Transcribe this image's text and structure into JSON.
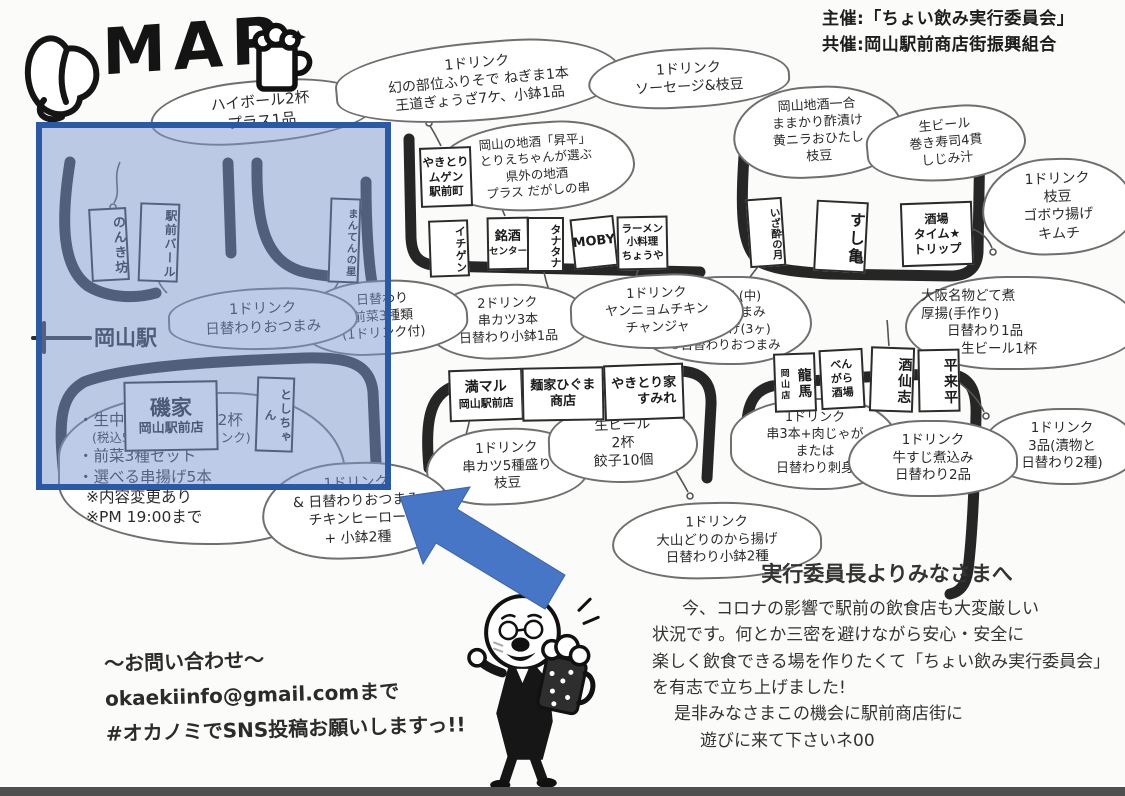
{
  "title": {
    "map": "MAP"
  },
  "credits": {
    "line1": "主催:「ちょい飲み実行委員会」",
    "line2": "共催:岡山駅前商店街振興組合"
  },
  "station": {
    "label": "岡山駅"
  },
  "icons": {
    "title_left": "peach-icon",
    "title_right": "beer-mug-icon",
    "mascot": "mascot-beer-character",
    "annotation": "highlight-arrow"
  },
  "colors": {
    "highlight_fill": "#7d98d2",
    "highlight_border": "#2a59a8",
    "arrow_blue": "#4776c6",
    "ink": "#1f1f1f"
  },
  "shops": {
    "nonkibo": {
      "name": "のんき坊"
    },
    "ekimae_bar": {
      "name": "駅前バール"
    },
    "manten": {
      "name": "まんてんの星"
    },
    "isoya": {
      "name": "磯家",
      "sub": "岡山駅前店"
    },
    "toshichan": {
      "name": "としちゃん"
    },
    "mugen": {
      "l1": "やきとり",
      "l2": "ムゲン",
      "l3": "駅前町"
    },
    "ichigen": {
      "name": "イチゲン"
    },
    "meishu": {
      "l1": "銘酒",
      "l2": "センター"
    },
    "tanatana": {
      "name": "タナタナ"
    },
    "moby": {
      "name": "MOBY"
    },
    "chouya": {
      "l1": "ラーメン",
      "l2": "小料理",
      "l3": "ちょうや"
    },
    "manmaru": {
      "l1": "満マル",
      "l2": "岡山駅前店"
    },
    "higuma": {
      "l1": "麺家ひぐま",
      "l2": "商店"
    },
    "sumire": {
      "l1": "やきとり家",
      "l2": "すみれ"
    },
    "izayoi": {
      "name": "いざ酔の月"
    },
    "sushikame": {
      "name": "すし亀"
    },
    "sakaba": {
      "l1": "酒場",
      "l2": "タイム★",
      "l3": "トリップ"
    },
    "ryoma": {
      "name": "龍馬",
      "sub": "岡山店"
    },
    "bengara": {
      "l1": "べん",
      "l2": "がら",
      "l3": "酒場"
    },
    "shusenshi": {
      "name": "酒仙志"
    },
    "heiraihei": {
      "name": "平来平"
    }
  },
  "clouds": {
    "c1": {
      "lines": [
        "ハイボール2杯",
        "プラス1品"
      ]
    },
    "c2": {
      "lines": [
        "1ドリンク",
        "幻の部位ふりそで ねぎま1本",
        "王道ぎょうざ7ケ、小鉢1品"
      ]
    },
    "c3": {
      "lines": [
        "1ドリンク",
        "ソーセージ&枝豆"
      ]
    },
    "c4": {
      "lines": [
        "岡山の地酒「昇平」",
        "とりえちゃんが選ぶ",
        "県外の地酒",
        "プラス だがしの串"
      ]
    },
    "c5": {
      "lines": [
        "岡山地酒一合",
        "ままかり酢漬け",
        "黄ニラおひたし",
        "枝豆"
      ]
    },
    "c6": {
      "lines": [
        "生ビール",
        "巻き寿司4貫",
        "しじみ汁"
      ]
    },
    "c7": {
      "lines": [
        "1ドリンク",
        "枝豆",
        "ゴボウ揚げ",
        "キムチ"
      ]
    },
    "c8": {
      "lines": [
        "瓶ビール(中)",
        "+2品おつまみ",
        "①からあげ(3ヶ)",
        "②日替わりおつまみ"
      ]
    },
    "c9": {
      "lines": [
        "大阪名物どて煮",
        "厚揚(手作り)",
        "日替わり1品",
        "生ビール1杯"
      ]
    },
    "c10": {
      "lines": [
        "1ドリンク",
        "3品(漬物と",
        "日替わり2種)"
      ]
    },
    "c11": {
      "lines": [
        "2ドリンク",
        "串カツ3本",
        "日替わり小鉢1品"
      ]
    },
    "c12": {
      "lines": [
        "1ドリンク",
        "ヤンニョムチキン",
        "チャンジャ"
      ]
    },
    "c13": {
      "lines": [
        "日替わり",
        "前菜3種類",
        "(1ドリンク付)"
      ]
    },
    "c14": {
      "lines": [
        "1ドリンク",
        "日替わりおつまみ"
      ]
    },
    "c15": {
      "lines": [
        "1ドリンク",
        "串カツ5種盛り",
        "枝豆"
      ]
    },
    "c16": {
      "lines": [
        "生ビール",
        "2杯",
        "餃子10個"
      ]
    },
    "c17": {
      "lines": [
        "1ドリンク",
        "大山どりのから揚げ",
        "日替わり小鉢2種"
      ]
    },
    "c18": {
      "lines": [
        "1ドリンク",
        "串3本+肉じゃが",
        "または",
        "日替わり刺身"
      ]
    },
    "c19": {
      "lines": [
        "1ドリンク",
        "牛すじ煮込み",
        "日替わり2品"
      ]
    },
    "c20": {
      "lines": [
        "・生中含むドリンク2杯",
        "(税込500円以下のドリンク)",
        "・前菜3種セット",
        "・選べる串揚げ5本",
        "※内容変更あり",
        "※PM 19:00まで"
      ]
    },
    "c21": {
      "lines": [
        "1ドリンク",
        "& 日替わりおつまみ",
        "チキンヒーロー",
        "+ 小鉢2種"
      ]
    }
  },
  "contact": {
    "line1": "～お問い合わせ～",
    "line2": "okaekiinfo@gmail.comまで",
    "line3": "#オカノミでSNS投稿お願いしますっ!!"
  },
  "message": {
    "title": "実行委員長よりみなさまへ",
    "lines": [
      "今、コロナの影響で駅前の飲食店も大変厳しい",
      "状況です。何とか三密を避けながら安心・安全に",
      "楽しく飲食できる場を作りたくて「ちょい飲み実行委員会」",
      "を有志で立ち上げました!",
      "是非みなさまこの機会に駅前商店街に",
      "遊びに来て下さいネ00"
    ]
  }
}
